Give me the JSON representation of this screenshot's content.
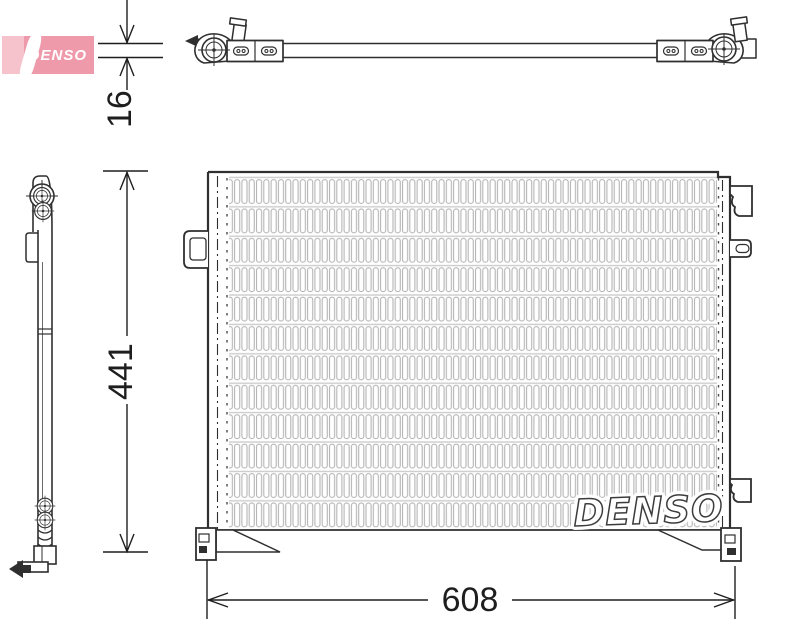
{
  "brand": {
    "logo_text": "DENSO",
    "logo_bg_color": "#ee9aab",
    "logo_text_color": "#ffffff"
  },
  "watermark": {
    "text": "DENSO"
  },
  "dimensions": {
    "depth": {
      "value": "16",
      "unit_hint": "mm",
      "orientation": "vertical"
    },
    "height": {
      "value": "441",
      "unit_hint": "mm",
      "orientation": "vertical"
    },
    "width": {
      "value": "608",
      "unit_hint": "mm",
      "orientation": "horizontal"
    }
  },
  "style": {
    "line_color": "#2f2f2f",
    "fin_color": "#b4b4b4",
    "background": "#ffffff"
  }
}
